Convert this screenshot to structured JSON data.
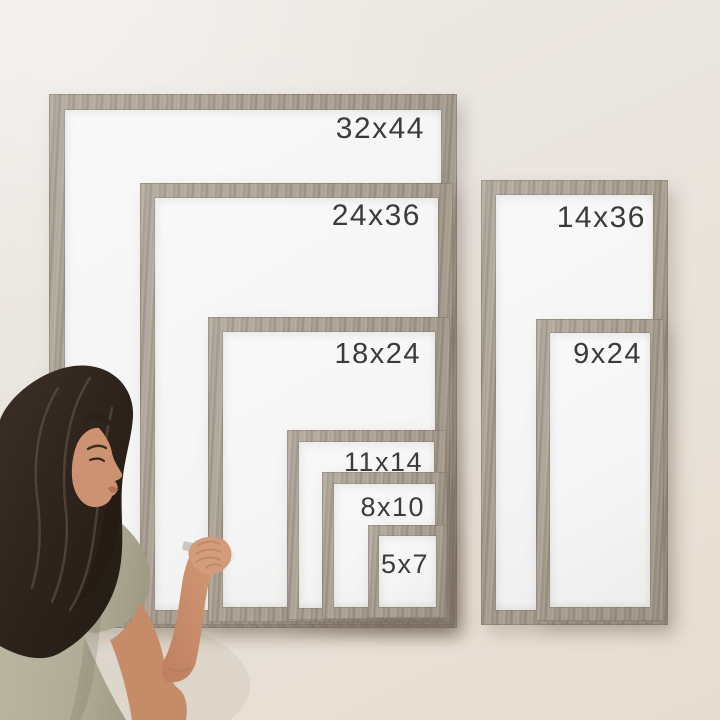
{
  "frames": [
    {
      "label": "32x44"
    },
    {
      "label": "24x36"
    },
    {
      "label": "14x36"
    },
    {
      "label": "18x24"
    },
    {
      "label": "9x24"
    },
    {
      "label": "11x14"
    },
    {
      "label": "8x10"
    },
    {
      "label": "5x7"
    }
  ],
  "colors": {
    "wall": "#eae4dd",
    "frame_wood": "#a89f92",
    "whiteboard": "#f6f6f6",
    "label_text": "#3b3b3b",
    "hair": "#2c221b",
    "skin": "#cc9271",
    "shirt": "#b3ae99",
    "marker": "#f3f1ec"
  }
}
